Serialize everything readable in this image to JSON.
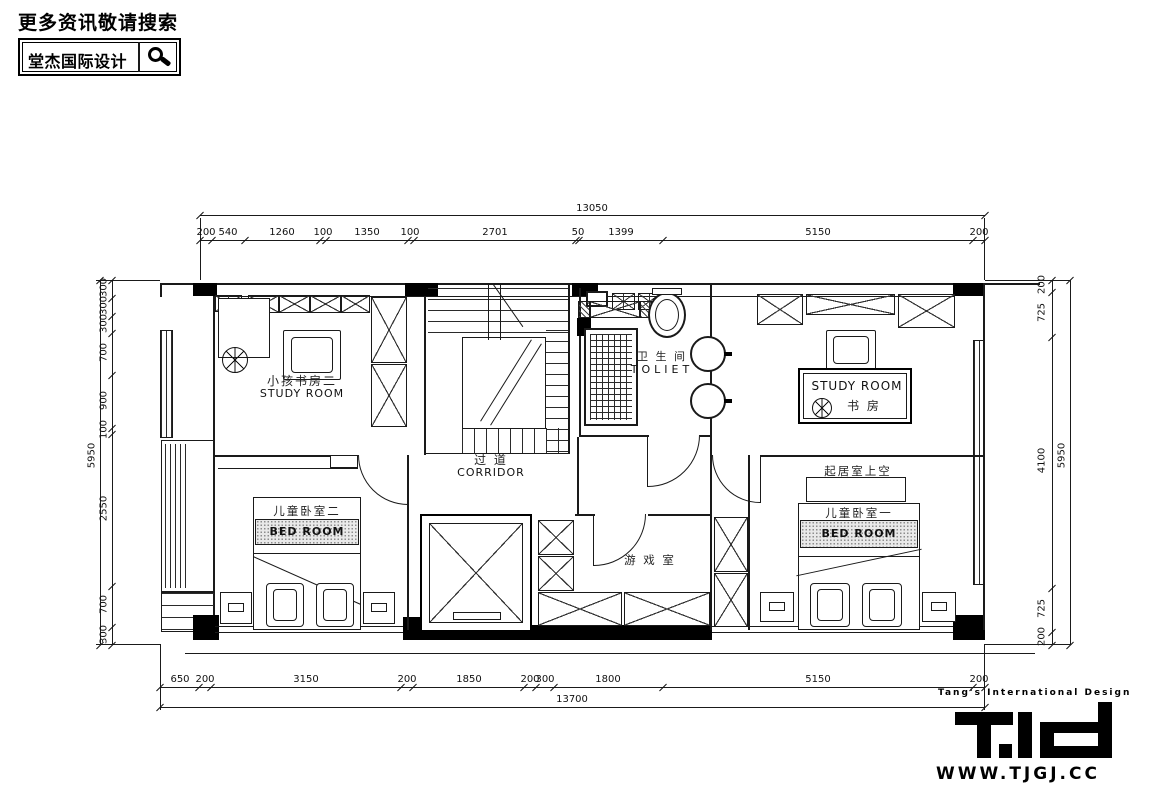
{
  "header": {
    "search_hint": "更多资讯敬请搜索",
    "brand": "堂杰国际设计",
    "search_icon": "magnifier"
  },
  "rooms": {
    "study_left_zh": "小孩书房二",
    "study_left_en": "STUDY ROOM",
    "corridor_zh": "过 道",
    "corridor_en": "CORRIDOR",
    "toilet_zh": "卫 生 间",
    "toilet_en": "TOLIET",
    "study_right_en": "STUDY ROOM",
    "study_right_zh": "书 房",
    "bed_left_zh": "儿童卧室二",
    "bed_left_en": "BED  ROOM",
    "bed_right_zh": "儿童卧室一",
    "bed_right_en": "BED  ROOM",
    "void_zh": "起居室上空",
    "game_zh": "游 戏 室"
  },
  "dims": {
    "top": {
      "total": "13050",
      "segs": [
        "200",
        "540",
        "1260",
        "100",
        "1350",
        "100",
        "2701",
        "50",
        "1399",
        "5150",
        "200"
      ]
    },
    "bottom": {
      "total": "13700",
      "segs": [
        "650",
        "200",
        "3150",
        "200",
        "1850",
        "200",
        "300",
        "1800",
        "5150",
        "200"
      ]
    },
    "left": {
      "total": "5950",
      "segs": [
        "300",
        "300",
        "300",
        "700",
        "900",
        "100",
        "2550",
        "700",
        "300"
      ]
    },
    "right": {
      "total": "5950",
      "segs": [
        "200",
        "725",
        "4100",
        "725",
        "200"
      ]
    }
  },
  "footer": {
    "tagline": "Tang's International Design",
    "logo": "T.id",
    "website": "WWW.TJGJ.CC"
  },
  "colors": {
    "ink": "#000000",
    "paper": "#ffffff"
  }
}
